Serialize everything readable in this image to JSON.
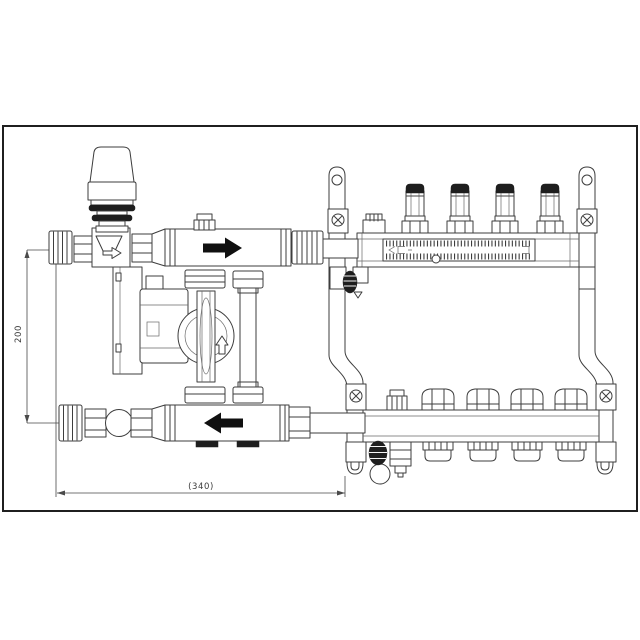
{
  "drawing": {
    "title": "manifold-with-mixing-pump-group-technical-drawing",
    "dimensions": {
      "height_label": "200",
      "width_label": "(340)"
    },
    "colors": {
      "background": "#ffffff",
      "frame": "#1f1f1f",
      "line": "#3d3d3d",
      "dark_fill": "#1e1e1e",
      "arrow_fill": "#101010"
    }
  }
}
